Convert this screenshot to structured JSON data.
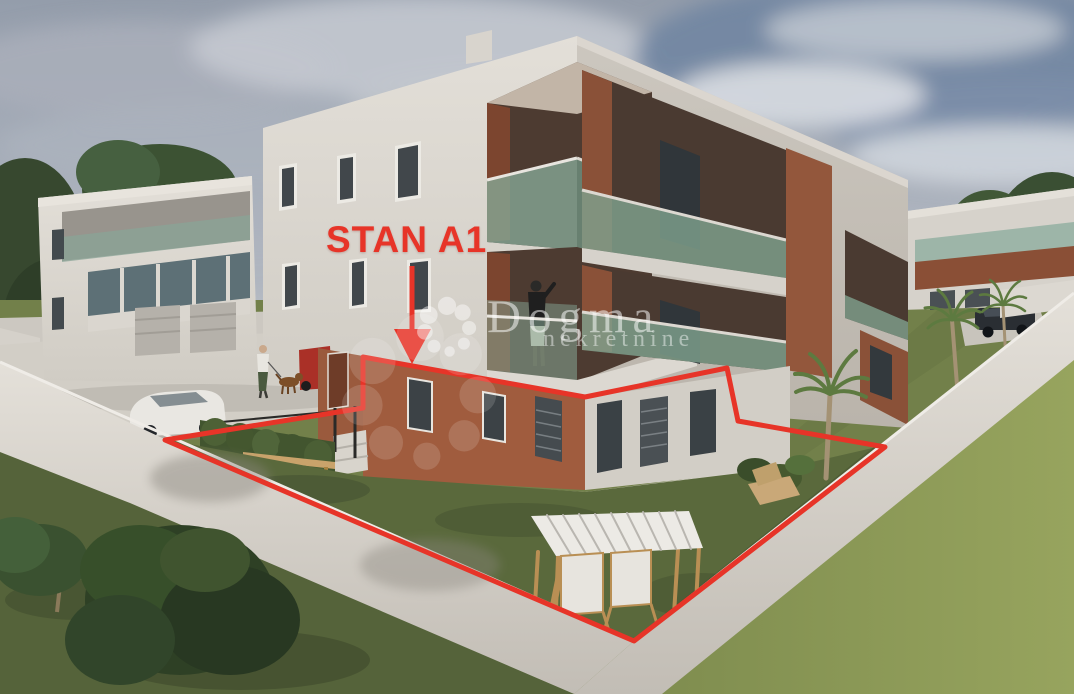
{
  "annotation": {
    "label": "STAN A1",
    "outline_color": "#e73428",
    "arrow_icon": "down-arrow"
  },
  "watermark": {
    "brand": "Dogma",
    "subtitle": "nekretnine",
    "logo_icon": "pinwheel-flower",
    "color": "#ffffff"
  },
  "palette": {
    "accent_red": "#e73428",
    "sky_top": "#949dab",
    "sky_bottom": "#ccd0d5",
    "facade_light": "#e0dcd5",
    "facade_shade": "#c7c2ba",
    "terracotta_lit": "#a05c3e",
    "terracotta_shadow": "#7c452f",
    "balcony_interior": "#4d3b31",
    "glass_teal": "#83a391",
    "wall_white": "#ddd9d2",
    "concrete": "#d2cec6",
    "grass_dark": "#55633a",
    "grass_yard": "#5a693c",
    "grass_light": "#8d9b59"
  },
  "scene": {
    "objects": [
      "apartment-building",
      "neighbor-building-left",
      "neighbor-building-right",
      "garden-wall",
      "ground-floor-yard",
      "pergola",
      "deck-chairs",
      "bench",
      "hedge",
      "white-car",
      "red-car",
      "suv-car",
      "person-walking-dog",
      "person-on-balcony",
      "palm-trees",
      "olive-trees",
      "lawn"
    ]
  }
}
